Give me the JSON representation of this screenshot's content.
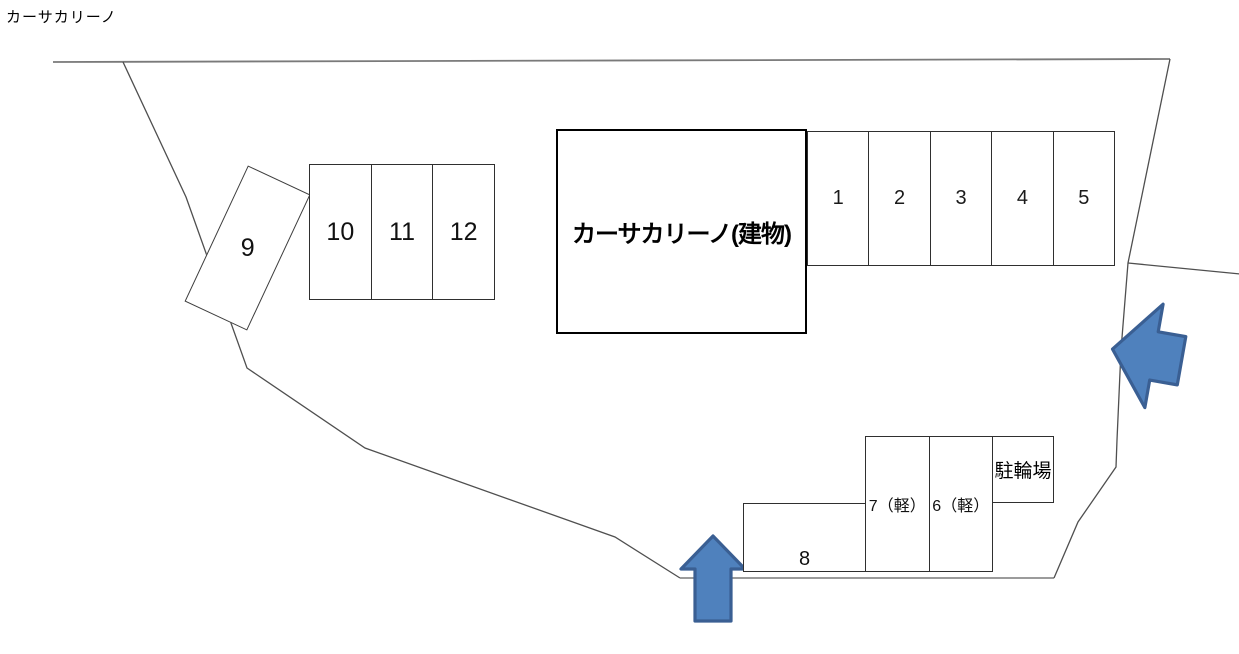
{
  "title": "カーサカリーノ",
  "building": {
    "label": "カーサカリーノ(建物)"
  },
  "spaces": {
    "row_right": [
      "1",
      "2",
      "3",
      "4",
      "5"
    ],
    "row_left": [
      "10",
      "11",
      "12"
    ],
    "angled": "9",
    "kei": [
      "7（軽）",
      "6（軽）"
    ],
    "single": "8",
    "bicycle": "駐輪場"
  },
  "icons": {
    "entrance_arrow_up": "up-arrow",
    "entrance_arrow_left": "left-arrow"
  },
  "colors": {
    "arrow_fill": "#4f81bd",
    "arrow_stroke": "#3a5f93",
    "boundary_line": "#4f4f4f",
    "boundary_line_light": "#9b9b9b",
    "box_line": "#2f2f2f"
  }
}
